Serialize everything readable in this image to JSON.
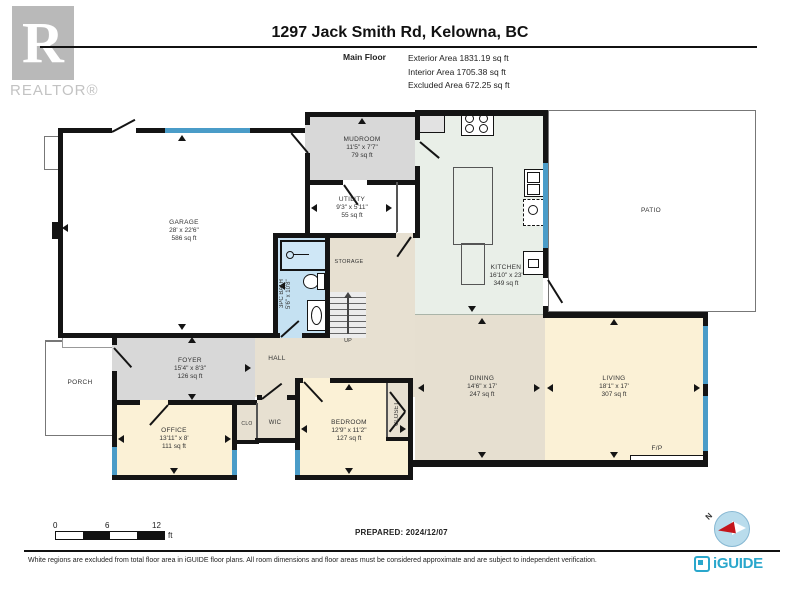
{
  "header": {
    "realtor_r": "R",
    "realtor_text": "REALTOR®",
    "title": "1297 Jack Smith Rd, Kelowna, BC",
    "floor_label": "Main Floor",
    "areas": {
      "exterior": "Exterior Area 1831.19 sq ft",
      "interior": "Interior Area 1705.38 sq ft",
      "excluded": "Excluded Area 672.25 sq ft"
    }
  },
  "rooms": {
    "garage": {
      "name": "GARAGE",
      "dims": "28' x 22'6\"",
      "area": "586 sq ft"
    },
    "mudroom": {
      "name": "MUDROOM",
      "dims": "11'5\" x 7'7\"",
      "area": "79 sq ft"
    },
    "utility": {
      "name": "UTILITY",
      "dims": "9'3\" x 5'11\"",
      "area": "55 sq ft"
    },
    "storage": {
      "name": "STORAGE"
    },
    "bath": {
      "name": "3PC BATH",
      "dims": "5'6\" x 10'8\""
    },
    "kitchen": {
      "name": "KITCHEN",
      "dims": "16'10\" x 23'",
      "area": "349 sq ft"
    },
    "patio": {
      "name": "PATIO"
    },
    "foyer": {
      "name": "FOYER",
      "dims": "15'4\" x 8'3\"",
      "area": "126 sq ft"
    },
    "porch": {
      "name": "PORCH"
    },
    "hall": {
      "name": "HALL"
    },
    "office": {
      "name": "OFFICE",
      "dims": "13'11\" x 8'",
      "area": "111 sq ft"
    },
    "clo": {
      "name": "CLO"
    },
    "wic": {
      "name": "WIC"
    },
    "bedroom": {
      "name": "BEDROOM",
      "dims": "12'9\" x 11'2\"",
      "area": "127 sq ft"
    },
    "closet": {
      "name": "CLOSET"
    },
    "dining": {
      "name": "DINING",
      "dims": "14'6\" x 17'",
      "area": "247 sq ft"
    },
    "living": {
      "name": "LIVING",
      "dims": "18'1\" x 17'",
      "area": "307 sq ft"
    },
    "fireplace": {
      "name": "F/P"
    },
    "stairs_up": "UP"
  },
  "scale": {
    "t0": "0",
    "t1": "6",
    "t2": "12",
    "unit": "ft"
  },
  "footer": {
    "prepared": "PREPARED: 2024/12/07",
    "compass_n": "N",
    "disclaimer": "White regions are excluded from total floor area in iGUIDE floor plans. All room dimensions and floor areas must be considered approximate and are subject to independent verification.",
    "brand": "iGUIDE"
  },
  "colors": {
    "wall": "#141414",
    "window_blue": "#4a9cc8",
    "room_grey": "#d8d8d8",
    "room_beige": "#e7e0d1",
    "room_cream": "#fbf1d6",
    "kitchen_green": "#e9efe8",
    "bath_blue": "#c5e1f2",
    "brand_teal": "#2aa7cc",
    "compass_red": "#c4161c"
  }
}
